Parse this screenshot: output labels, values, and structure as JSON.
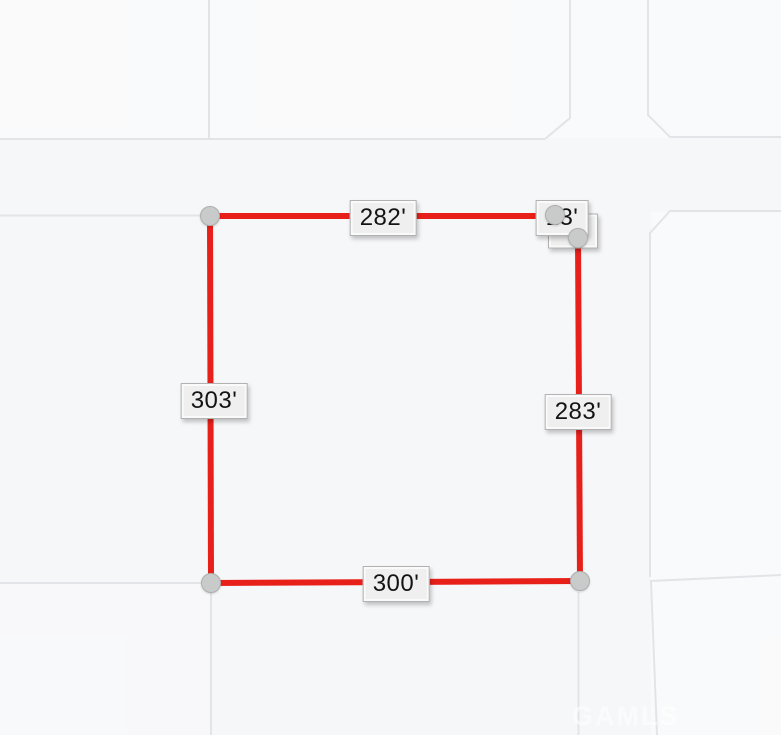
{
  "map": {
    "background_color": "#f6f7f9",
    "road_line_color": "#e2e4e8",
    "parcel": {
      "stroke_color": "#e8201a",
      "vertex_count": 5,
      "dimensions": {
        "top": "282'",
        "corner_cut": "13'",
        "right": "283'",
        "bottom": "300'",
        "left": "303'"
      }
    },
    "labels": [
      {
        "id": "corner-back",
        "text": "",
        "x": 573,
        "y": 231,
        "z": 4
      },
      {
        "id": "top",
        "text": "282'",
        "x": 383,
        "y": 218,
        "z": 5
      },
      {
        "id": "right",
        "text": "283'",
        "x": 578,
        "y": 412,
        "z": 5
      },
      {
        "id": "bottom",
        "text": "300'",
        "x": 396,
        "y": 584,
        "z": 5
      },
      {
        "id": "left",
        "text": "303'",
        "x": 214,
        "y": 401,
        "z": 5
      },
      {
        "id": "corner-front",
        "text": "13'",
        "x": 562,
        "y": 218,
        "z": 6
      }
    ],
    "markers": [
      {
        "id": "top-left",
        "x": 210,
        "y": 216
      },
      {
        "id": "top-right-a",
        "x": 555,
        "y": 215
      },
      {
        "id": "top-right-b",
        "x": 578,
        "y": 238
      },
      {
        "id": "bottom-right",
        "x": 580,
        "y": 581
      },
      {
        "id": "bottom-left",
        "x": 211,
        "y": 583
      }
    ],
    "marker_color": "#c9cbcb",
    "label_box_color": "#efefef",
    "watermark": {
      "text": "GAMLS"
    }
  }
}
